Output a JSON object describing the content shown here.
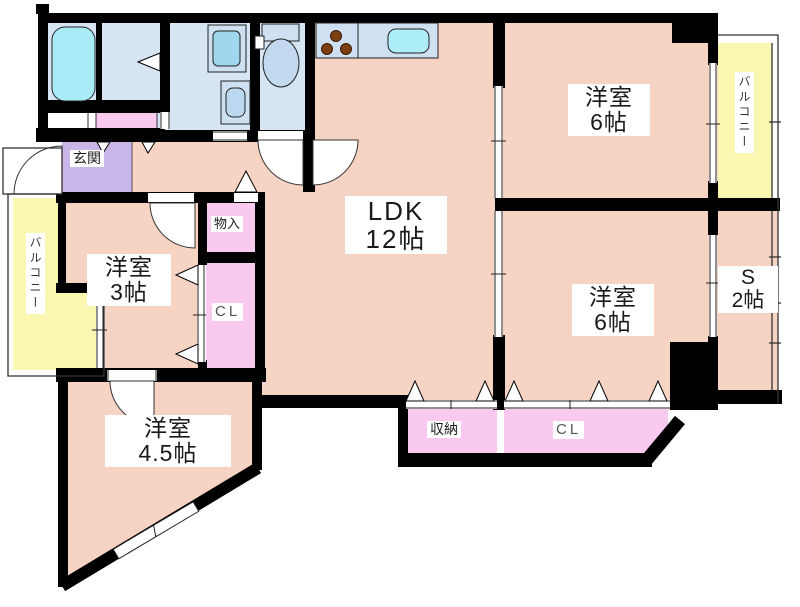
{
  "floorplan": {
    "type": "apartment-floorplan",
    "rooms": {
      "ldk": {
        "name": "LDK",
        "size": "12帖"
      },
      "bedroom_ne": {
        "name": "洋室",
        "size": "6帖"
      },
      "bedroom_e": {
        "name": "洋室",
        "size": "6帖"
      },
      "service_room": {
        "name": "S",
        "size": "2帖"
      },
      "bedroom_w": {
        "name": "洋室",
        "size": "3帖"
      },
      "bedroom_sw": {
        "name": "洋室",
        "size": "4.5帖"
      },
      "entrance": {
        "name": "玄関"
      },
      "hall_storage": {
        "name": "物入"
      },
      "closet_west": {
        "name": "CL"
      },
      "storage_south": {
        "name": "収納"
      },
      "closet_south": {
        "name": "CL"
      },
      "balcony_west": {
        "name": "バルコニー"
      },
      "balcony_northeast": {
        "name": "バルコニー"
      }
    },
    "colors": {
      "wall": "#000000",
      "room_floor": "#f6d3c3",
      "closet_pink": "#f9c9f0",
      "entrance_purple": "#c9b6e8",
      "balcony_yellow": "#faf7b3",
      "wet_area_blue": "#d6e4f4",
      "fixture_cyan": "#a9ecf7",
      "burner_brown": "#7b3f10"
    }
  }
}
